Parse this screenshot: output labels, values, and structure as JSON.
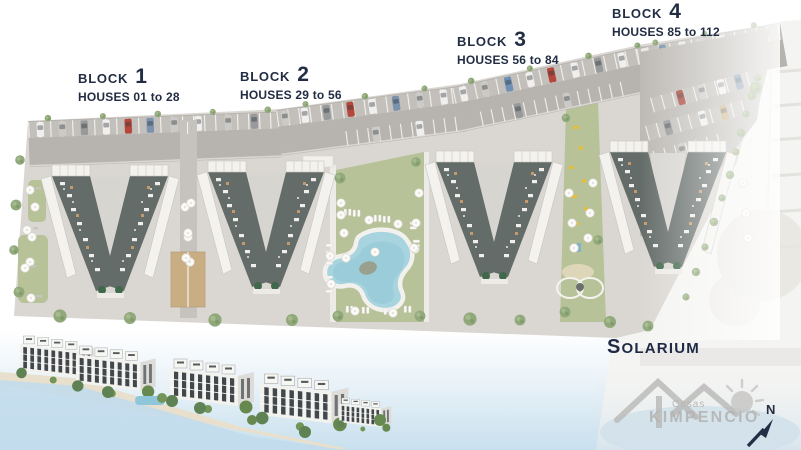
{
  "blocks": [
    {
      "label": "BLOCK",
      "number": "1",
      "houses": "HOUSES 01 to 28"
    },
    {
      "label": "BLOCK",
      "number": "2",
      "houses": "HOUSES 29 to 56"
    },
    {
      "label": "BLOCK",
      "number": "3",
      "houses": "HOUSES 56 to 84"
    },
    {
      "label": "BLOCK",
      "number": "4",
      "houses": "HOUSES 85 to 112"
    }
  ],
  "area_labels": {
    "solarium": "SOLARIUM"
  },
  "logo": {
    "subtitle": "Casas",
    "name": "KIMPENCIO"
  },
  "compass": {
    "north": "N"
  },
  "colors": {
    "navy": "#222d44",
    "lawn": "#b7c298",
    "pool": "#a7d4de",
    "roof": "#646c69",
    "paving": "#dad7d2",
    "road": "#b7b4af",
    "sky_water": "#c8e0ee",
    "logo_gray": "#b9b8b6",
    "tan_pergola": "#c9ae84",
    "tree": "#90a87a"
  }
}
